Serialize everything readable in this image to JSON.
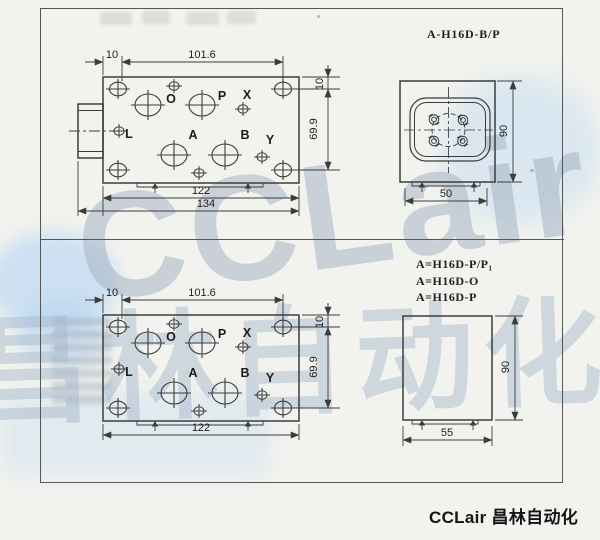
{
  "watermark": {
    "brand": "CCLair",
    "brand_cn": "昌林自动化"
  },
  "footer": {
    "brand": "CCLair 昌林自动化"
  },
  "top_assembly": {
    "model": "A-H16D-B/P",
    "plan": {
      "ports": {
        "o": "O",
        "p": "P",
        "x": "X",
        "l": "L",
        "a": "A",
        "b": "B",
        "y": "Y"
      },
      "dims": {
        "edge_offset": "10",
        "bolt_pitch": "101.6",
        "body_width": "122",
        "overall_width": "134",
        "top_edge": "10",
        "bolt_span": "69.9"
      }
    },
    "side": {
      "dims": {
        "height": "90",
        "width": "50"
      }
    }
  },
  "bottom_assembly": {
    "models": [
      "A=H16D-P/P₁",
      "A=H16D-O",
      "A=H16D-P"
    ],
    "plan": {
      "ports": {
        "o": "O",
        "p": "P",
        "x": "X",
        "l": "L",
        "a": "A",
        "b": "B",
        "y": "Y"
      },
      "dims": {
        "edge_offset": "10",
        "bolt_pitch": "101.6",
        "body_width": "122",
        "top_edge": "10",
        "bolt_span": "69.9"
      }
    },
    "side": {
      "dims": {
        "height": "90",
        "width": "55"
      }
    }
  }
}
